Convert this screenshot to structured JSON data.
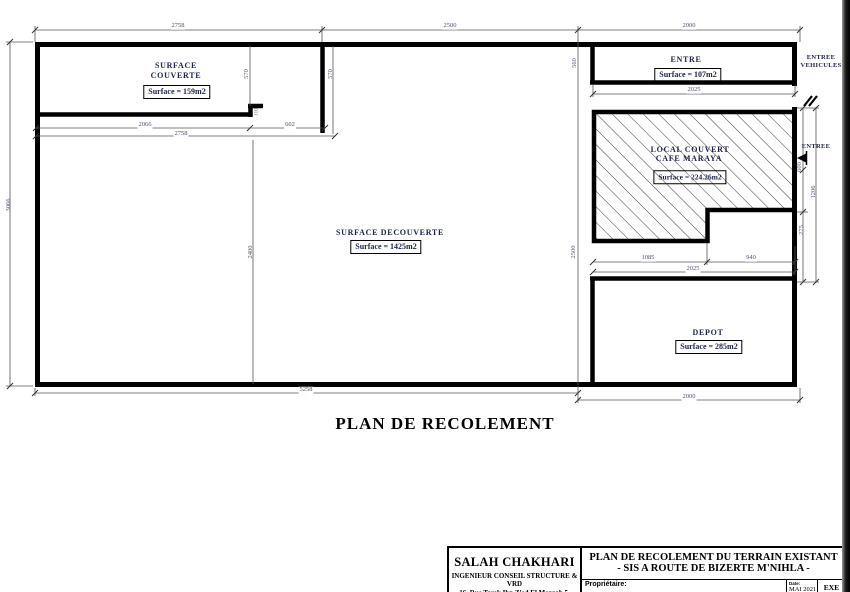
{
  "plan": {
    "title": "PLAN DE RECOLEMENT"
  },
  "rooms": {
    "surface_couverte": {
      "name1": "SURFACE",
      "name2": "COUVERTE",
      "surface": "Surface = 159m2"
    },
    "surface_decouverte": {
      "name": "SURFACE DECOUVERTE",
      "surface": "Surface = 1425m2"
    },
    "entre": {
      "name": "ENTRE",
      "surface": "Surface = 107m2"
    },
    "local_couvert": {
      "name1": "LOCAL COUVERT",
      "name2": "CAFE MARAYA",
      "surface": "Surface = 224.26m2"
    },
    "depot": {
      "name": "DEPOT",
      "surface": "Surface = 285m2"
    }
  },
  "annotations": {
    "entree_vehicules1": "ENTREE",
    "entree_vehicules2": "VEHICULES",
    "entree": "ENTREE"
  },
  "dims": {
    "top_left": "2758",
    "top_mid": "2500",
    "top_right": "2000",
    "sub_left": "2066",
    "sub_right": "602",
    "sub_total": "2758",
    "entre_width": "2025",
    "cafe_left": "1085",
    "cafe_right": "940",
    "cafe_total": "2025",
    "bottom_left": "5258",
    "bottom_right": "2000",
    "left_height": "3066",
    "couv_h_left": "570",
    "couv_h_right": "570",
    "step": "110",
    "decouv_h": "2400",
    "mid_h": "2500",
    "mid_top": "560",
    "right_gate": "600",
    "right_h": "1206",
    "right_low": "275"
  },
  "title_block": {
    "engineer_name": "SALAH CHAKHARI",
    "engineer_role": "INGENIEUR CONSEIL STRUCTURE & VRD",
    "engineer_address": "16, Rue Tarek Ibn Zied El Menzah 5, Ariana",
    "project_line1": "PLAN DE RECOLEMENT DU TERRAIN EXISTANT",
    "project_line2": "- SIS A ROUTE DE BIZERTE M'NIHLA -",
    "owner_label": "Propriétaire:",
    "date_label": "Date:",
    "date_value": "MAI 2021",
    "status": "EXE"
  },
  "colors": {
    "wall": "#000000",
    "dim_text": "#4a5570",
    "label_text": "#1b2245"
  }
}
